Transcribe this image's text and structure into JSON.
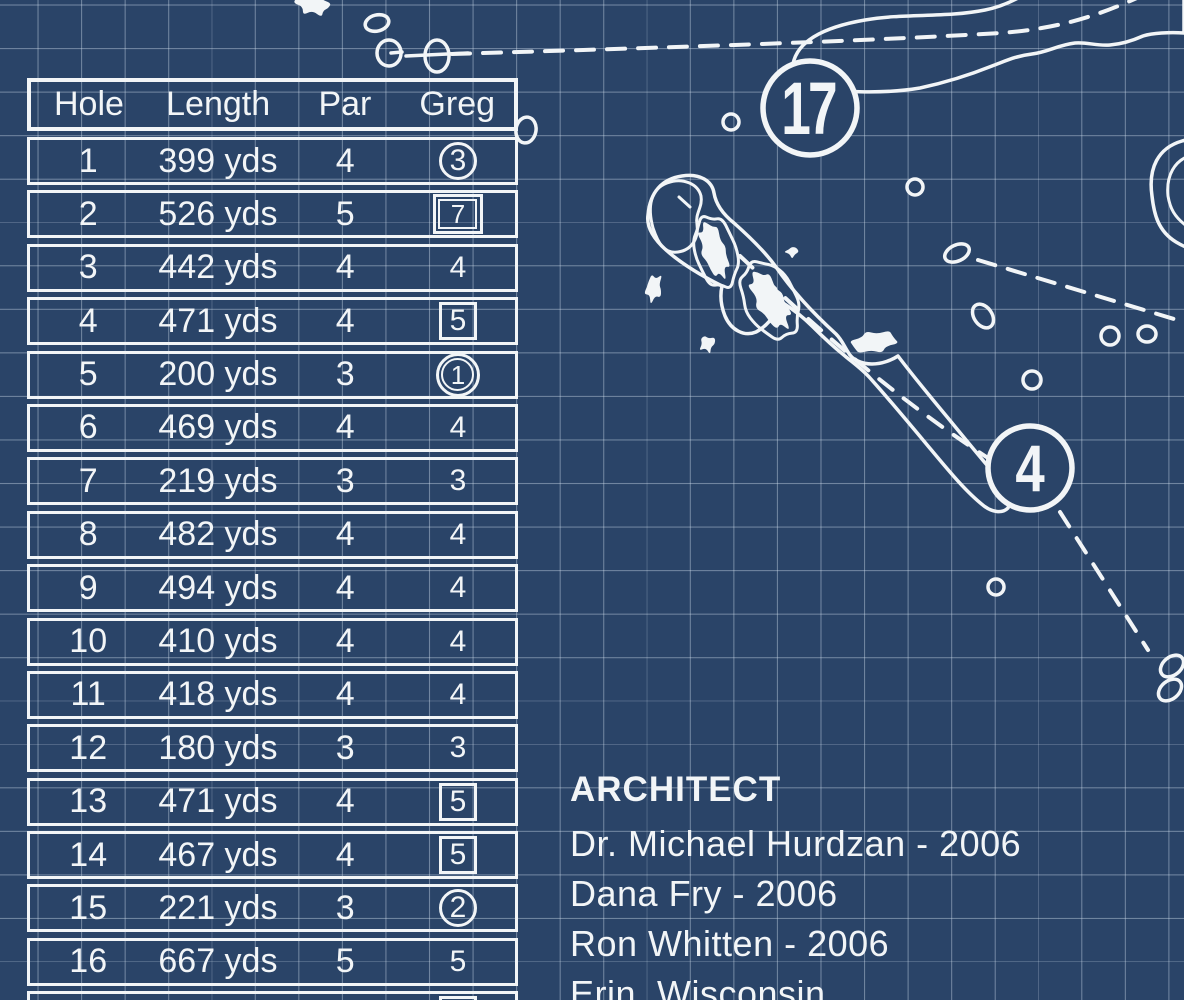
{
  "colors": {
    "background": "#2A4468",
    "ink": "#F2F5F7",
    "grid_line": "rgba(210,224,238,0.42)"
  },
  "scorecard": {
    "columns": [
      "Hole",
      "Length",
      "Par",
      "Greg"
    ],
    "rows": [
      {
        "hole": "1",
        "length": "399 yds",
        "par": "4",
        "score": "3",
        "marker": "circle"
      },
      {
        "hole": "2",
        "length": "526 yds",
        "par": "5",
        "score": "7",
        "marker": "double-square"
      },
      {
        "hole": "3",
        "length": "442 yds",
        "par": "4",
        "score": "4",
        "marker": "none"
      },
      {
        "hole": "4",
        "length": "471 yds",
        "par": "4",
        "score": "5",
        "marker": "square"
      },
      {
        "hole": "5",
        "length": "200 yds",
        "par": "3",
        "score": "1",
        "marker": "double-circle"
      },
      {
        "hole": "6",
        "length": "469 yds",
        "par": "4",
        "score": "4",
        "marker": "none"
      },
      {
        "hole": "7",
        "length": "219 yds",
        "par": "3",
        "score": "3",
        "marker": "none"
      },
      {
        "hole": "8",
        "length": "482 yds",
        "par": "4",
        "score": "4",
        "marker": "none"
      },
      {
        "hole": "9",
        "length": "494 yds",
        "par": "4",
        "score": "4",
        "marker": "none"
      },
      {
        "hole": "10",
        "length": "410 yds",
        "par": "4",
        "score": "4",
        "marker": "none"
      },
      {
        "hole": "11",
        "length": "418 yds",
        "par": "4",
        "score": "4",
        "marker": "none"
      },
      {
        "hole": "12",
        "length": "180 yds",
        "par": "3",
        "score": "3",
        "marker": "none"
      },
      {
        "hole": "13",
        "length": "471 yds",
        "par": "4",
        "score": "5",
        "marker": "square"
      },
      {
        "hole": "14",
        "length": "467 yds",
        "par": "4",
        "score": "5",
        "marker": "square"
      },
      {
        "hole": "15",
        "length": "221 yds",
        "par": "3",
        "score": "2",
        "marker": "circle"
      },
      {
        "hole": "16",
        "length": "667 yds",
        "par": "5",
        "score": "5",
        "marker": "none"
      },
      {
        "hole": "17",
        "length": "",
        "par": "",
        "score": "",
        "marker": "square"
      }
    ]
  },
  "architect": {
    "heading": "ARCHITECT",
    "lines": [
      "Dr. Michael Hurdzan  -  2006",
      "Dana Fry  -  2006",
      "Ron Whitten  -  2006",
      "Erin, Wisconsin"
    ]
  },
  "map": {
    "holes": [
      {
        "number": "17"
      },
      {
        "number": "4"
      }
    ]
  }
}
